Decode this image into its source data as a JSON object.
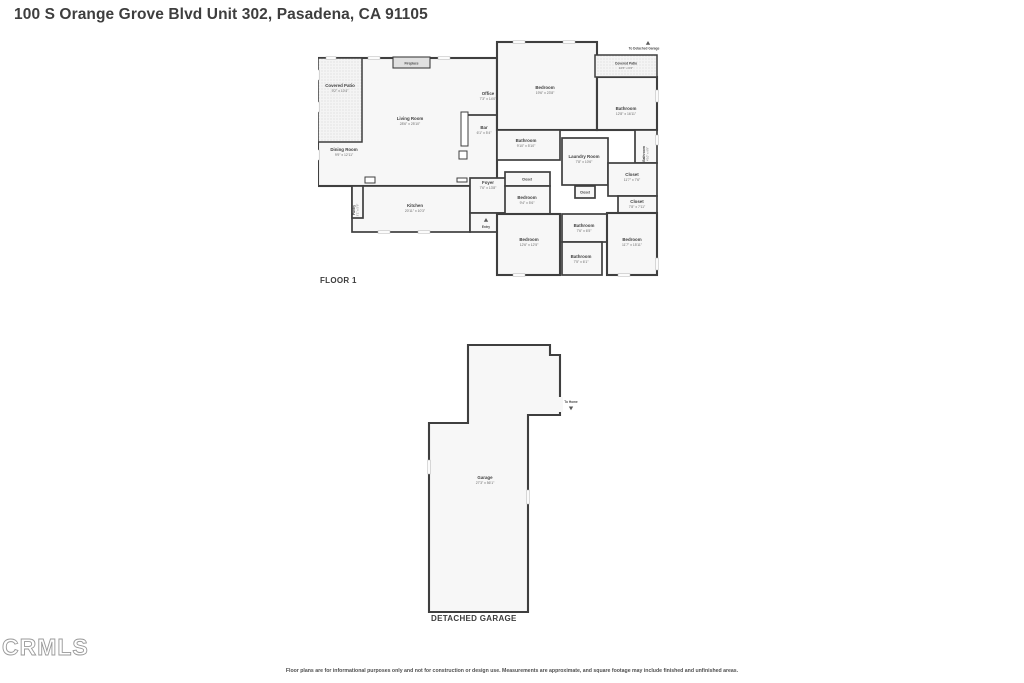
{
  "title": "100 S Orange Grove Blvd Unit 302, Pasadena, CA 91105",
  "watermark": "CRMLS",
  "disclaimer": "Floor plans are for informational purposes only and not for construction or design use. Measurements are approximate, and square footage may include finished and unfinished areas.",
  "colors": {
    "walls": "#3f3f3f",
    "room_fill": "#f7f7f7",
    "patio_fill": "#f4f4f4",
    "title_text": "#3e3e3e",
    "dims_text": "#6a6a6a"
  },
  "floor1": {
    "label": "FLOOR 1",
    "annotations": {
      "to_garage": "To Detached Garage",
      "entry": "Entry",
      "fireplace": "Fireplace"
    },
    "rooms": {
      "covered_patio_left": {
        "name": "Covered Patio",
        "dims": "9'2\" x 10'4\""
      },
      "dining": {
        "name": "Dining Room",
        "dims": "9'9\" x 12'11\""
      },
      "living": {
        "name": "Living Room",
        "dims": "28'6\" x 25'10\""
      },
      "office": {
        "name": "Office",
        "dims": "7'3\" x 14'0\""
      },
      "bar": {
        "name": "Bar",
        "dims": "6'1\" x 5'4\""
      },
      "kitchen": {
        "name": "Kitchen",
        "dims": "20'11\" x 10'3\""
      },
      "pantry": {
        "name": "Pantry",
        "dims": "3'1\" x 5'6\""
      },
      "foyer": {
        "name": "Foyer",
        "dims": "7'6\" x 13'8\""
      },
      "bedroom_master": {
        "name": "Bedroom",
        "dims": "19'6\" x 23'8\""
      },
      "covered_patio_right": {
        "name": "Covered Patio",
        "dims": "10'6\" x 6'2\""
      },
      "bathroom_master": {
        "name": "Bathroom",
        "dims": "12'8\" x 16'11\""
      },
      "bathroom_2": {
        "name": "Bathroom",
        "dims": "9'10\" x 5'10\""
      },
      "laundry": {
        "name": "Laundry Room",
        "dims": "7'8\" x 10'6\""
      },
      "bathroom_side": {
        "name": "Bathroom",
        "dims": "4'10\" x 6'9\""
      },
      "closet_master": {
        "name": "Closet",
        "dims": "11'7\" x 7'6\""
      },
      "closet_2": {
        "name": "Closet",
        "dims": "7'8\" x 7'11\""
      },
      "closet_3": {
        "name": "Closet"
      },
      "closet_4": {
        "name": "Closet"
      },
      "bedroom_small": {
        "name": "Bedroom",
        "dims": "9'4\" x 5'6\""
      },
      "bathroom_mid": {
        "name": "Bathroom",
        "dims": "7'6\" x 6'5\""
      },
      "bedroom_bl": {
        "name": "Bedroom",
        "dims": "12'6\" x 12'5\""
      },
      "bathroom_bottom": {
        "name": "Bathroom",
        "dims": "7'5\" x 6'1\""
      },
      "bedroom_br": {
        "name": "Bedroom",
        "dims": "11'7\" x 15'11\""
      }
    }
  },
  "garage_plan": {
    "label": "DETACHED GARAGE",
    "to_home": "To Home",
    "rooms": {
      "garage": {
        "name": "Garage",
        "dims": "27'3\" x 56'1\""
      }
    }
  }
}
